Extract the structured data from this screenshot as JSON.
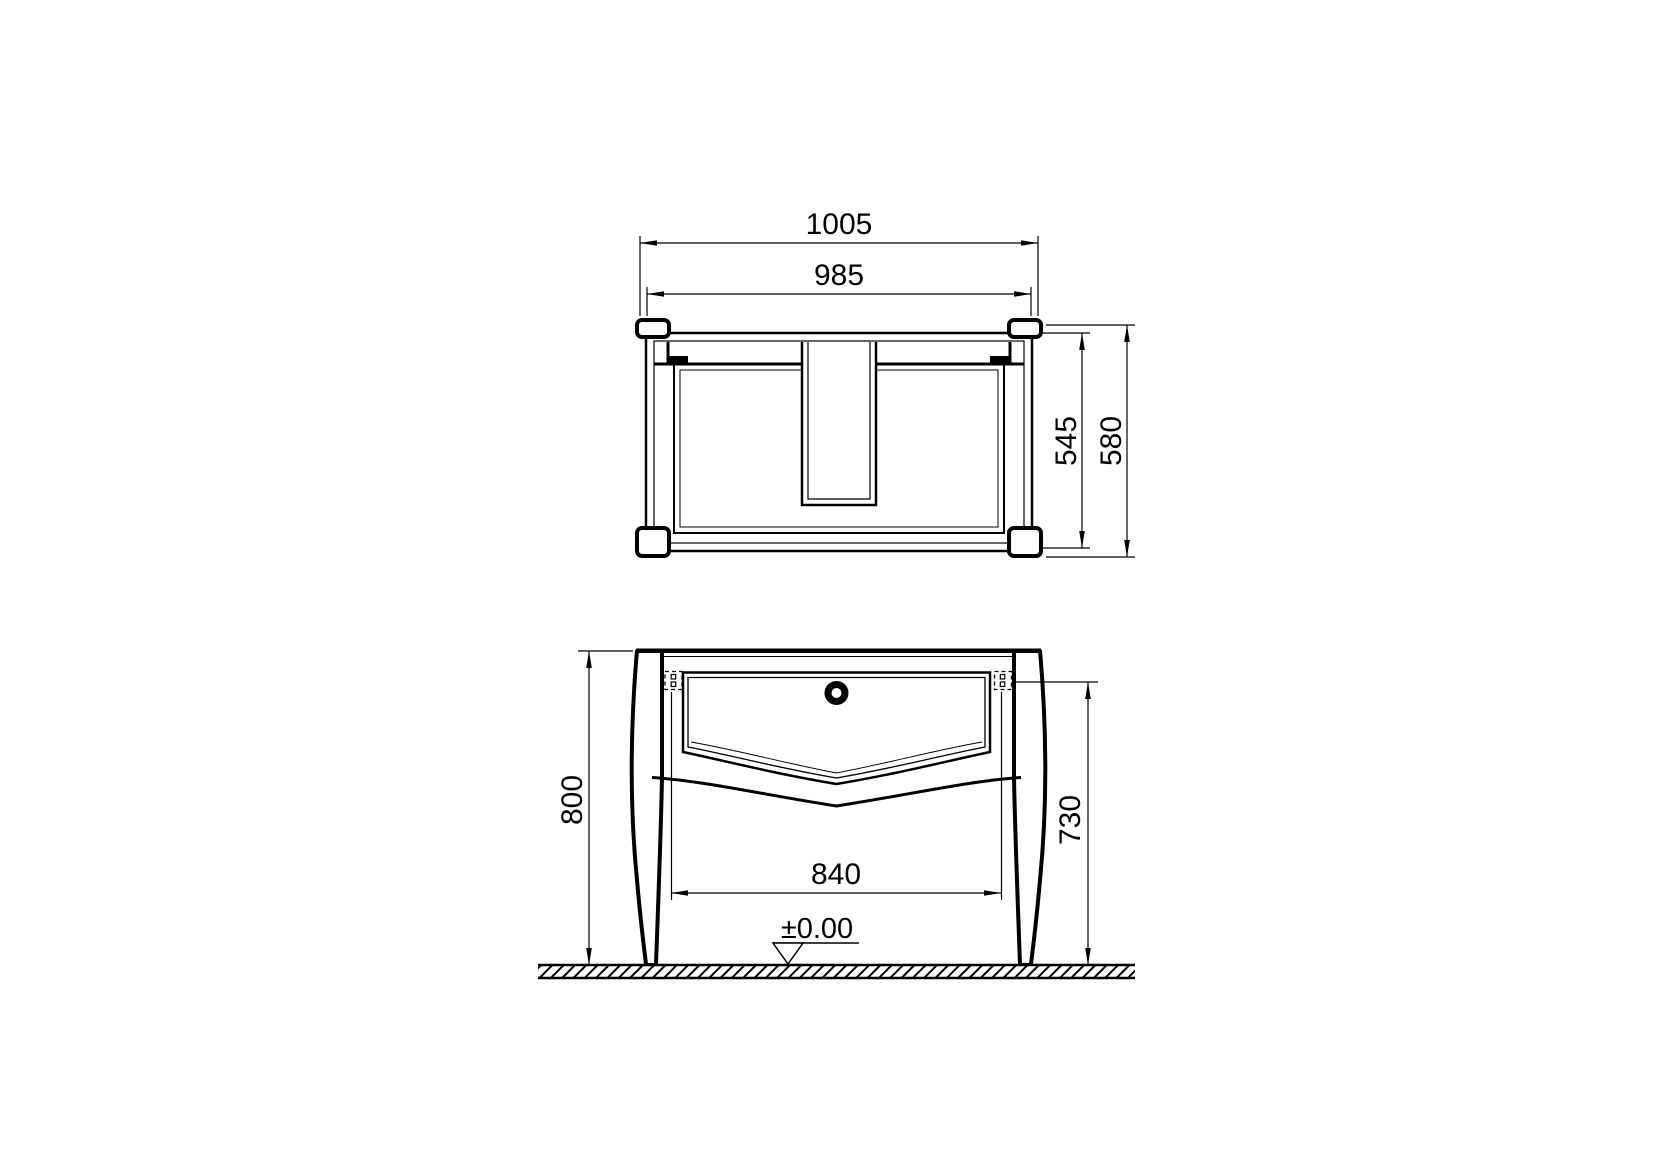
{
  "background": "#ffffff",
  "line_color": "#000000",
  "top_view": {
    "width_overall": "1005",
    "width_inner": "985",
    "depth_inner": "545",
    "depth_overall": "580"
  },
  "front_view": {
    "height_overall": "800",
    "height_to_underside": "730",
    "width_between_legs": "840",
    "floor_level": "±0.00"
  }
}
